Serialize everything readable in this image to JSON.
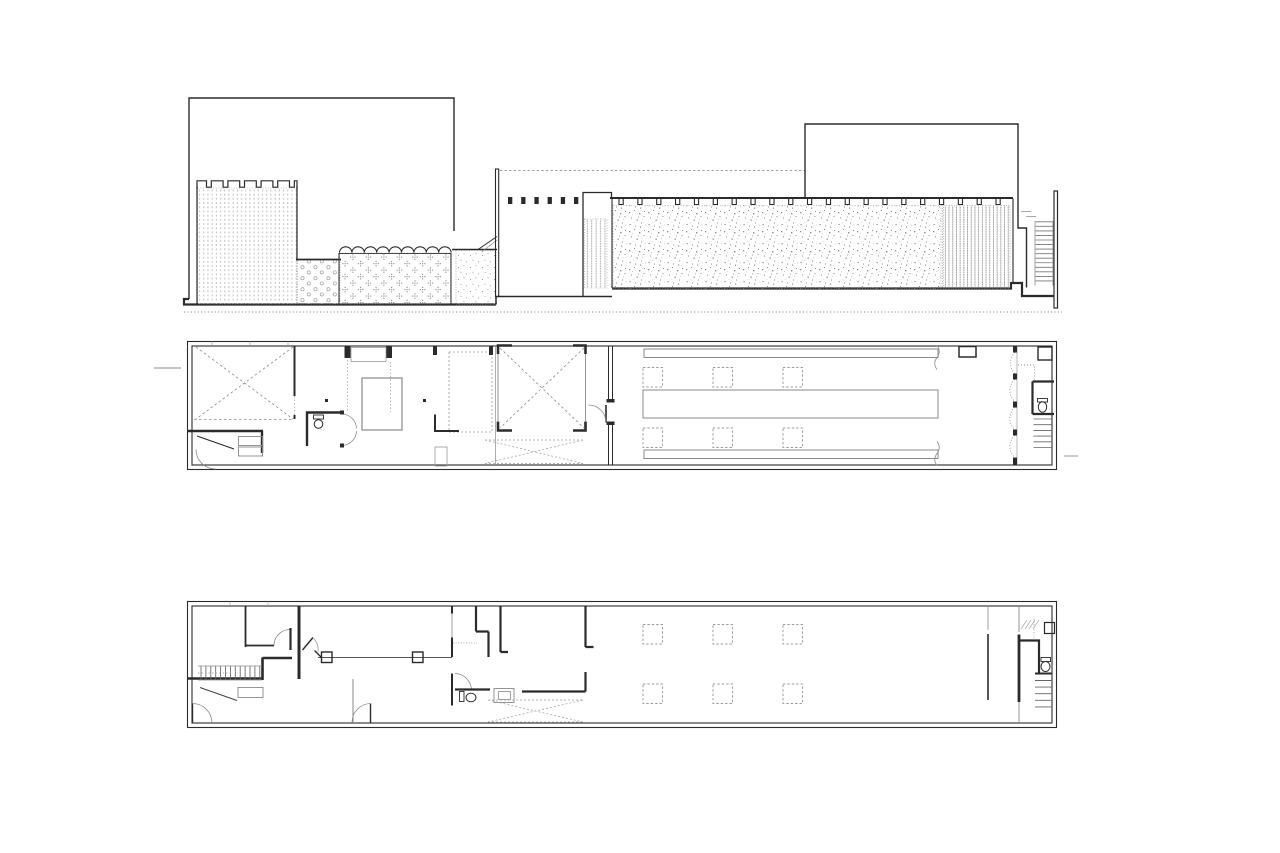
{
  "sheet": {
    "background": "#ffffff",
    "ink_color": "#2b2b2b",
    "light_line_color": "#8a8a8a",
    "hatch_color": "#a0a0a0"
  },
  "drawings": {
    "section": {
      "label": "longitudinal section and street elevation with hatched masonry wall panels, crenellated parapet, clerestory openings and end ladder"
    },
    "upper_plan": {
      "label": "upper floor plan: double-height voids marked with dashed crosses, bathroom, patio, long hall with roof-light bars, dashed column grid, folding partition, WC and stair at right end"
    },
    "ground_plan": {
      "label": "ground floor plan: entrance stair, partitioned front rooms, WC and counter, open hall with dashed column grid, WC and stair at right end"
    }
  },
  "legend": {
    "hatches": [
      "vertical-dash masonry",
      "circle hatch",
      "floral hatch",
      "sparse stipple",
      "vertical stripe",
      "random stipple",
      "dense vertical dash"
    ]
  }
}
